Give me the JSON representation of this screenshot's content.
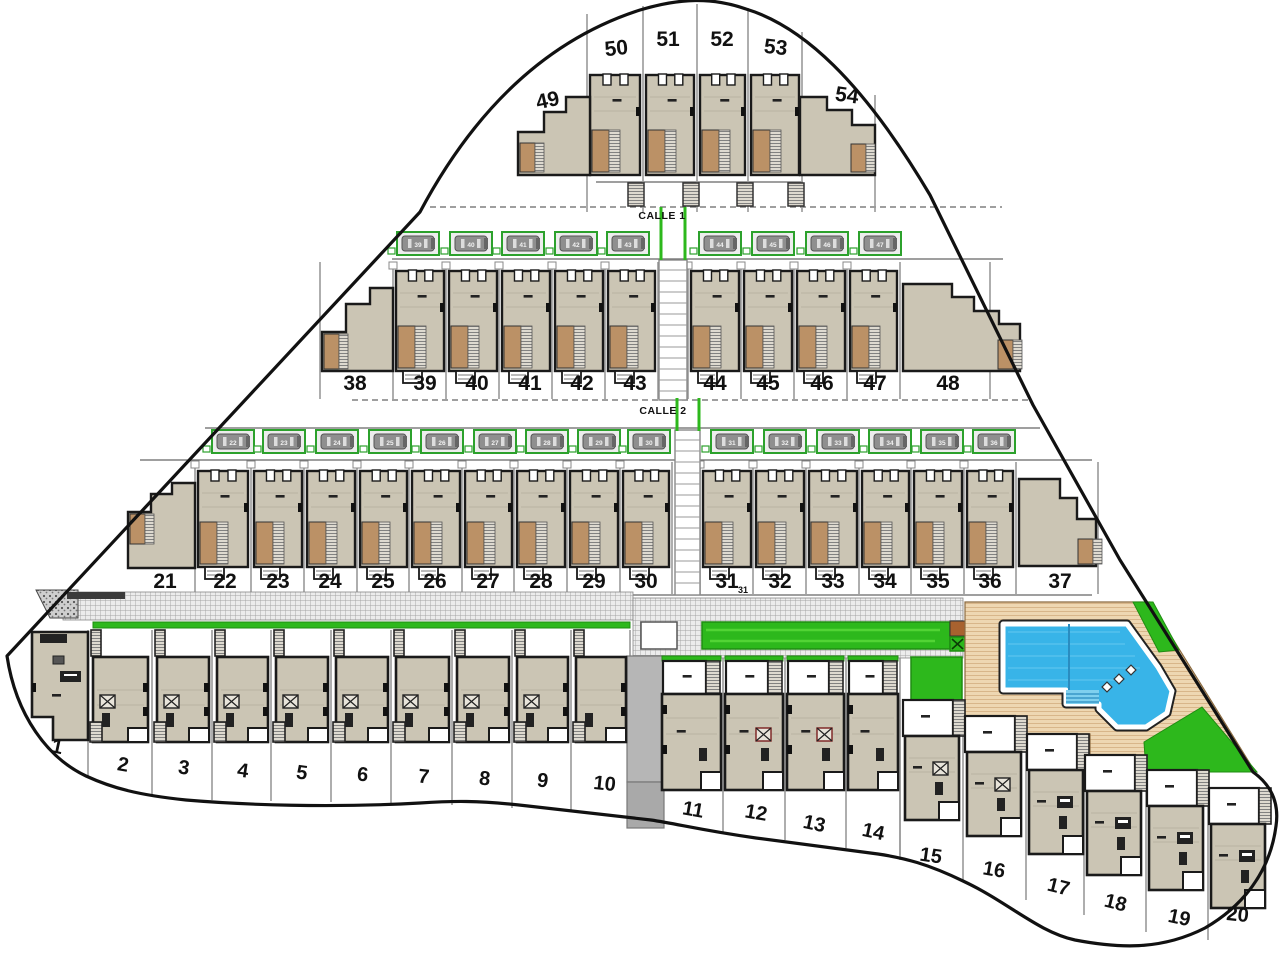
{
  "plan": {
    "street_labels": [
      {
        "id": "calle1",
        "text": "CALLE 1"
      },
      {
        "id": "calle2",
        "text": "CALLE 2"
      }
    ],
    "rows": {
      "top": {
        "plots": [
          49,
          50,
          51,
          52,
          53,
          54
        ]
      },
      "middle": {
        "plots": [
          38,
          39,
          40,
          41,
          42,
          43,
          44,
          45,
          46,
          47,
          48
        ]
      },
      "lower": {
        "plots": [
          21,
          22,
          23,
          24,
          25,
          26,
          27,
          28,
          29,
          30,
          31,
          32,
          33,
          34,
          35,
          36,
          37
        ],
        "subscript_plot": "31"
      },
      "bottom_left": {
        "plots": [
          1,
          2,
          3,
          4,
          5,
          6,
          7,
          8,
          9,
          10
        ]
      },
      "bottom_middle": {
        "plots": [
          11,
          12,
          13,
          14
        ]
      },
      "bottom_right": {
        "plots": [
          15,
          16,
          17,
          18,
          19,
          20
        ]
      }
    },
    "parking": {
      "upper_numbers": [
        39,
        40,
        41,
        42,
        43,
        44,
        45,
        46,
        47
      ],
      "lower_numbers": [
        22,
        23,
        24,
        25,
        26,
        27,
        28,
        29,
        30,
        31,
        32,
        33,
        34,
        35,
        36
      ]
    },
    "colors": {
      "boundary": "#111111",
      "building_fill": "#cbc5b4",
      "building_border": "#1a1a1a",
      "building_inner_line": "#b9b3a2",
      "patio_brown": "#bb9166",
      "lawn_green": "#2db81c",
      "parking_green": "#2ca12c",
      "pool_blue": "#38b4e8",
      "pool_steps": "#7fd0ef",
      "pool_lane": "#2a8cc0",
      "deck_tan": "#eed7b2",
      "deck_line": "#d8b68a",
      "walkway_gray": "#ececec",
      "walkway_grid": "#a3a3a3",
      "road_gray": "#b6b6b6",
      "divider_gray": "#9a9a9a",
      "text": "#111111",
      "white": "#ffffff"
    }
  }
}
